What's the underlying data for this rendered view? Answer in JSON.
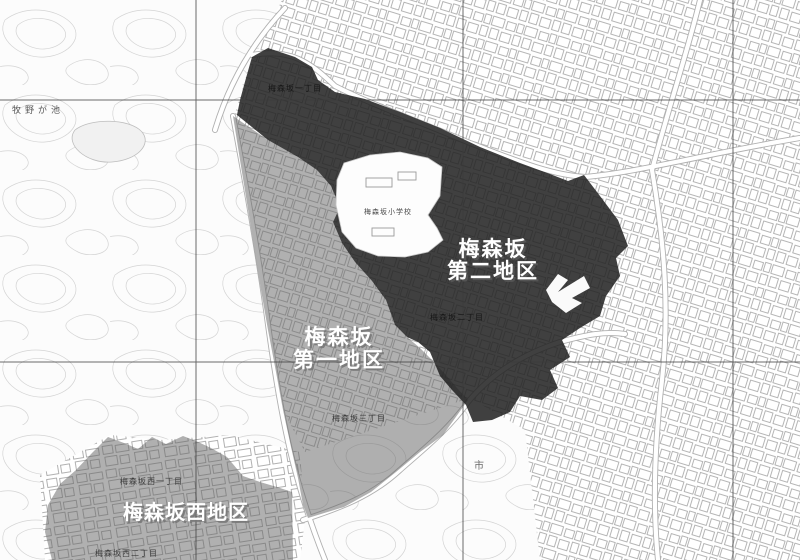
{
  "districts": {
    "dai2": {
      "label_line1": "梅森坂",
      "label_line2": "第二地区",
      "overlay_color": "rgba(33,33,33,0.86)"
    },
    "dai1": {
      "label_line1": "梅森坂",
      "label_line2": "第一地区",
      "overlay_color": "rgba(98,98,98,0.50)"
    },
    "nishi": {
      "label": "梅森坂西地区",
      "overlay_color": "rgba(98,98,98,0.50)"
    }
  },
  "map_labels": [
    {
      "text": "梅森坂一丁目"
    },
    {
      "text": "梅森坂二丁目"
    },
    {
      "text": "梅森坂三丁目"
    },
    {
      "text": "梅森坂西一丁目"
    },
    {
      "text": "梅森坂西二丁目"
    },
    {
      "text": "牧野が池"
    },
    {
      "text": "梅森坂小学校"
    },
    {
      "text": "市"
    }
  ],
  "colors": {
    "background": "#fcfcfc",
    "building_line": "#a3a3a3",
    "contour_line": "#d4d4d4",
    "road_casing": "#b0b0b0",
    "road_fill": "#ffffff",
    "grid_line": "#3a3a3a"
  }
}
